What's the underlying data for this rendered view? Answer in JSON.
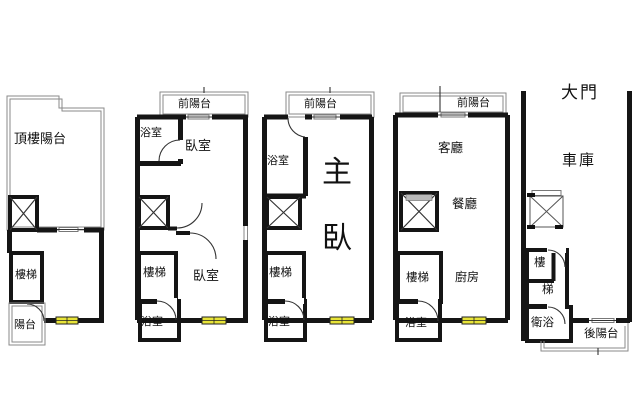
{
  "canvas": {
    "width": 640,
    "height": 413,
    "background": "#ffffff"
  },
  "colors": {
    "wall": "#151515",
    "outline": "#8a8a8a",
    "window_fill": "#e8e438",
    "window_stroke": "#222222",
    "fixture_gray": "#b9b9b9"
  },
  "floors": [
    {
      "id": "rooftop",
      "labels": {
        "roof_terrace": "頂樓陽台",
        "stairs": "樓梯",
        "balcony": "陽台"
      }
    },
    {
      "id": "bedroom-floor-a",
      "labels": {
        "front_balcony": "前陽台",
        "bathroom_top": "浴室",
        "bedroom_top": "臥室",
        "stairs": "樓梯",
        "bedroom_bottom": "臥室",
        "bathroom_bottom": "浴室"
      }
    },
    {
      "id": "bedroom-floor-b",
      "labels": {
        "front_balcony": "前陽台",
        "bathroom_top": "浴室",
        "master_bedroom": "主臥",
        "stairs": "樓梯",
        "bathroom_bottom": "浴室"
      }
    },
    {
      "id": "living-floor",
      "labels": {
        "front_balcony": "前陽台",
        "living_room": "客廳",
        "dining_room": "餐廳",
        "stairs": "樓梯",
        "kitchen": "廚房",
        "bathroom": "浴室"
      }
    },
    {
      "id": "ground-floor",
      "labels": {
        "main_door": "大門",
        "garage": "車庫",
        "stairs_upper": "樓",
        "stairs_lower": "梯",
        "bathroom": "衛浴",
        "rear_balcony": "後陽台"
      }
    }
  ]
}
